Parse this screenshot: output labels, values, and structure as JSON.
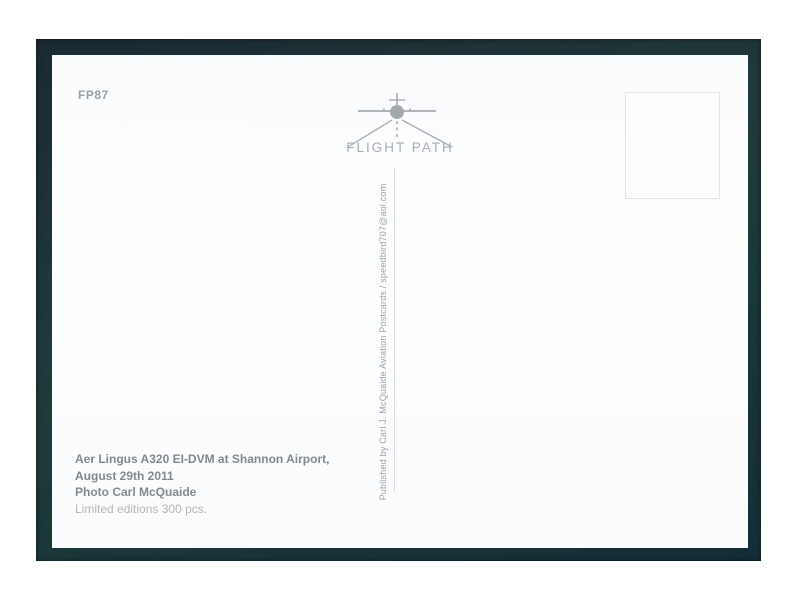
{
  "photo": {
    "frame_color": "#1d3134",
    "card_color": "#fbfcfd"
  },
  "postcard": {
    "code": "FP87",
    "logo": {
      "brand": "FLIGHT PATH",
      "icon": "airplane-front-runway-icon",
      "color": "#a6abb0"
    },
    "publisher_vertical_text": "Published by Carl J. McQuaide Aviation Postcards / speedbird707@aol.com",
    "stamp_box": {
      "border_color": "#e2e4e6"
    },
    "caption": {
      "title": "Aer Lingus A320 EI-DVM at Shannon Airport,",
      "date": "August 29th 2011",
      "photo_credit": "Photo Carl McQuaide",
      "edition": "Limited editions 300 pcs."
    }
  }
}
